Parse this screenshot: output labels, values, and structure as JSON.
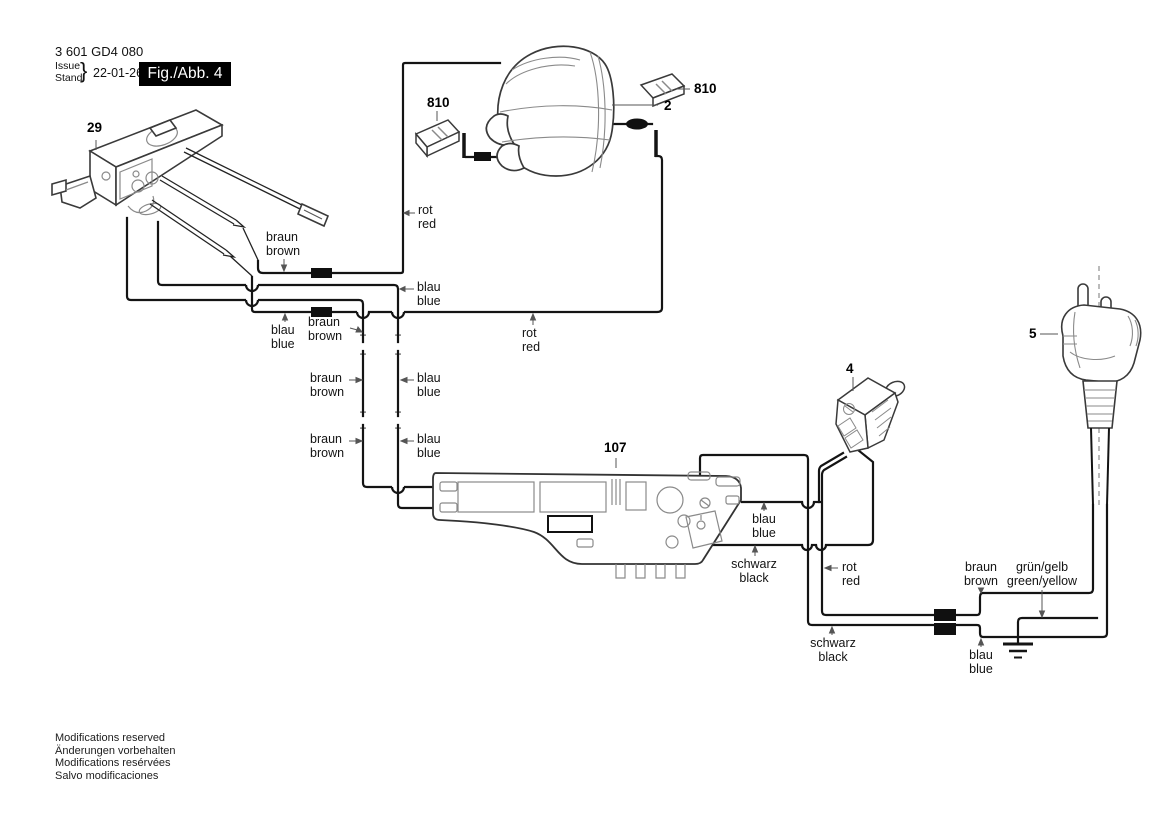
{
  "header": {
    "part_number": "3 601 GD4 080",
    "issue_label_en": "Issue",
    "issue_label_de": "Stand",
    "brace": "}",
    "issue_date": "22-01-26",
    "figure_label": "Fig./Abb. 4"
  },
  "part_labels": {
    "switch": "29",
    "brush_left": "810",
    "field_coil": "2",
    "brush_right": "810",
    "plug": "5",
    "cord_connector": "4",
    "module": "107"
  },
  "wire_labels": [
    {
      "id": "rot-top",
      "de": "rot",
      "en": "red"
    },
    {
      "id": "braun-switch",
      "de": "braun",
      "en": "brown"
    },
    {
      "id": "blau-mid-right",
      "de": "blau",
      "en": "blue"
    },
    {
      "id": "blau-left",
      "de": "blau",
      "en": "blue"
    },
    {
      "id": "braun-mid",
      "de": "braun",
      "en": "brown"
    },
    {
      "id": "rot-return",
      "de": "rot",
      "en": "red"
    },
    {
      "id": "braun-col-1",
      "de": "braun",
      "en": "brown"
    },
    {
      "id": "blau-col-1",
      "de": "blau",
      "en": "blue"
    },
    {
      "id": "braun-col-2",
      "de": "braun",
      "en": "brown"
    },
    {
      "id": "blau-col-2",
      "de": "blau",
      "en": "blue"
    },
    {
      "id": "blau-module",
      "de": "blau",
      "en": "blue"
    },
    {
      "id": "schwarz-module",
      "de": "schwarz",
      "en": "black"
    },
    {
      "id": "rot-connector",
      "de": "rot",
      "en": "red"
    },
    {
      "id": "braun-cord",
      "de": "braun",
      "en": "brown"
    },
    {
      "id": "gruen-gelb",
      "de": "grün/gelb",
      "en": "green/yellow"
    },
    {
      "id": "schwarz-lower",
      "de": "schwarz",
      "en": "black"
    },
    {
      "id": "blau-cord",
      "de": "blau",
      "en": "blue"
    }
  ],
  "marks": {
    "plus": "+",
    "minus": "−"
  },
  "footer": {
    "line1": "Modifications reserved",
    "line2": "Änderungen vorbehalten",
    "line3": "Modifications resérvées",
    "line4": "Salvo modificaciones"
  },
  "colors": {
    "wire": "#141414",
    "outline": "#3a3a3a",
    "detail": "#8a8a8a",
    "figure_box_bg": "#000000",
    "figure_box_text": "#ffffff",
    "background": "#ffffff"
  }
}
